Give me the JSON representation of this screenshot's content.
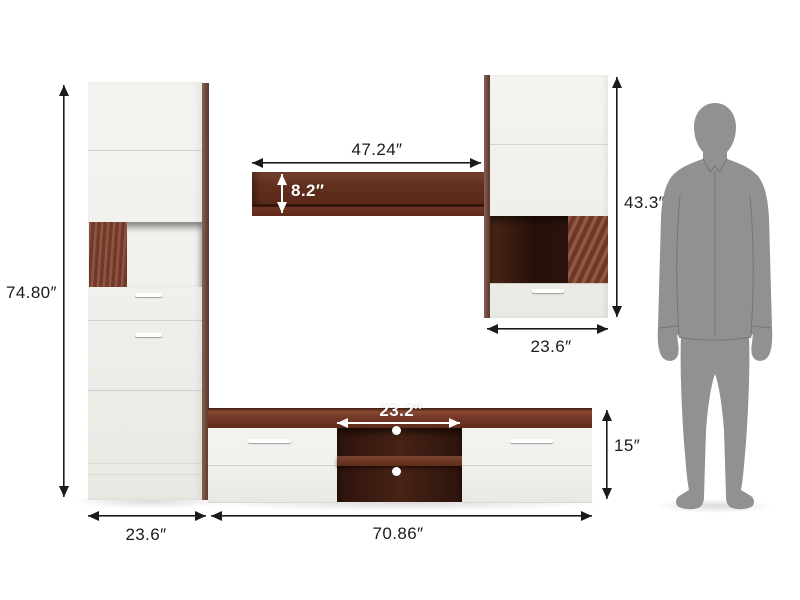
{
  "diagram": {
    "type": "furniture-dimension-diagram",
    "subject": "modular TV wall unit with standing human silhouette for scale"
  },
  "dims": {
    "left_cabinet_height": "74.80″",
    "left_cabinet_width": "23.6″",
    "wall_shelf_width": "47.24″",
    "wall_shelf_height": "8.2″",
    "right_cabinet_height": "43.3″",
    "right_cabinet_width": "23.6″",
    "tv_unit_open_width": "23.2″",
    "tv_unit_height": "15″",
    "tv_unit_width": "70.86″"
  },
  "colors": {
    "panel_white": "#f1f0ec",
    "wood_light": "#8a4a35",
    "wood_medium": "#713626",
    "wood_dark": "#5e2b1b",
    "niche_dark": "#26100a",
    "dimension_line": "#1b1b1b",
    "overlay_label": "#ffffff",
    "silhouette_gray": "#919191"
  },
  "figure": {
    "silhouette": "standing-man"
  }
}
